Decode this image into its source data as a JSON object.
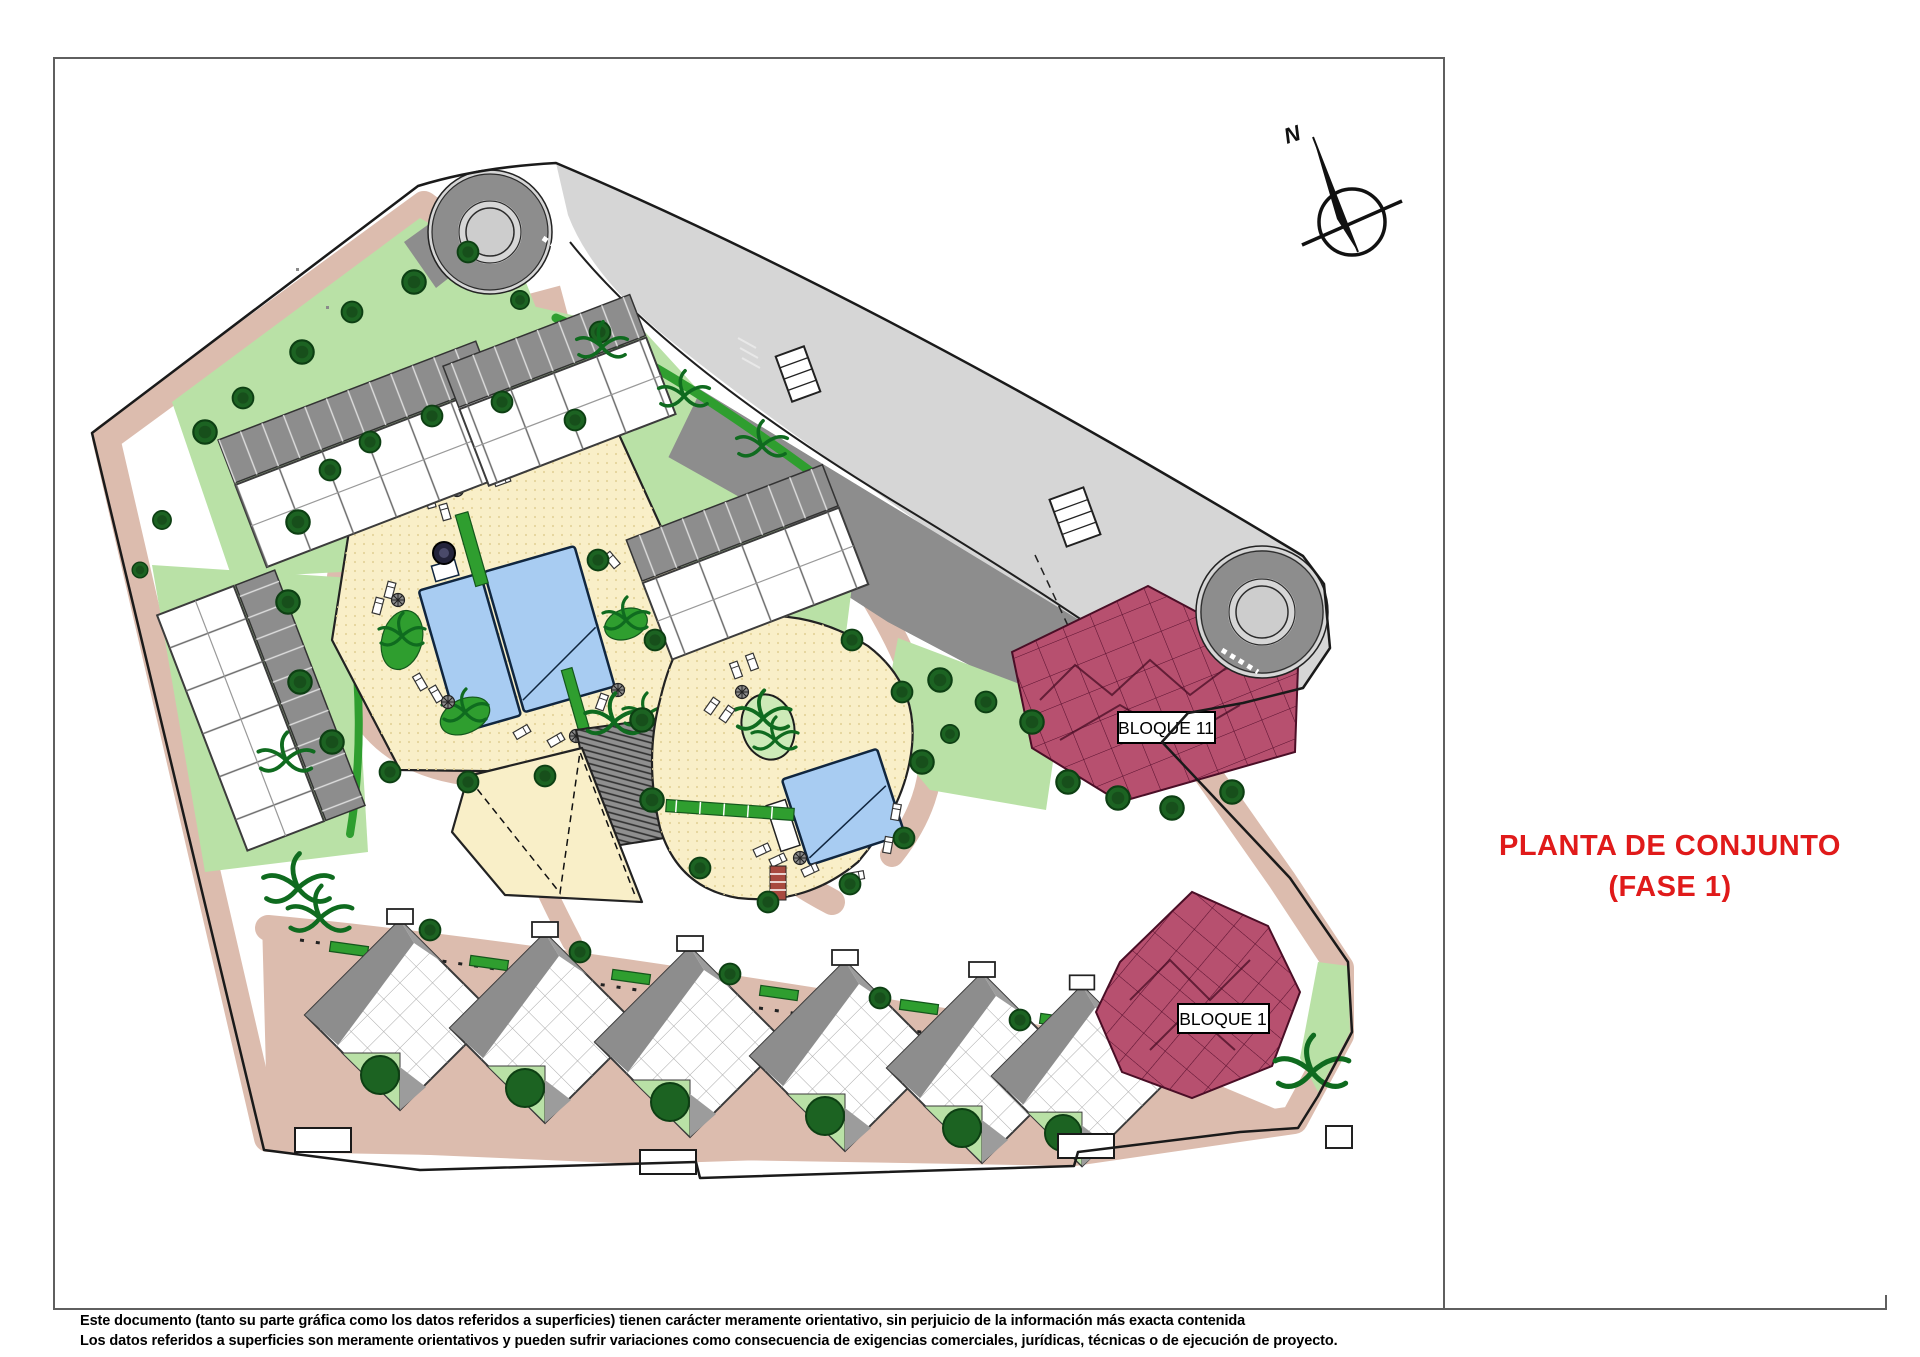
{
  "title": {
    "line1": "PLANTA DE CONJUNTO",
    "line2": "(FASE 1)"
  },
  "north": {
    "label": "N"
  },
  "plan": {
    "block_labels": {
      "bloque11": "BLOQUE 11",
      "bloque1": "BLOQUE 1"
    },
    "colors": {
      "title-red": "#e01a1a",
      "road-pink": "#dcbcae",
      "road-gray": "#d6d6d6",
      "parking-gray": "#8d8d8d",
      "lawn": "#b9e1a6",
      "hedge": "#2f9e2f",
      "tree": "#1c6322",
      "cream": "#f9efc8",
      "pool": "#a8ccf2",
      "pool-edge": "#10263f",
      "bloque": "#b7506f"
    }
  },
  "footer": {
    "line1": "Este documento (tanto su parte gráfica como los datos referidos a superficies) tienen carácter meramente orientativo, sin perjuicio de la información más exacta contenida",
    "line2": "Los datos referidos a superficies son meramente orientativos y pueden sufrir variaciones como consecuencia de exigencias comerciales, jurídicas, técnicas o de ejecución de proyecto."
  }
}
